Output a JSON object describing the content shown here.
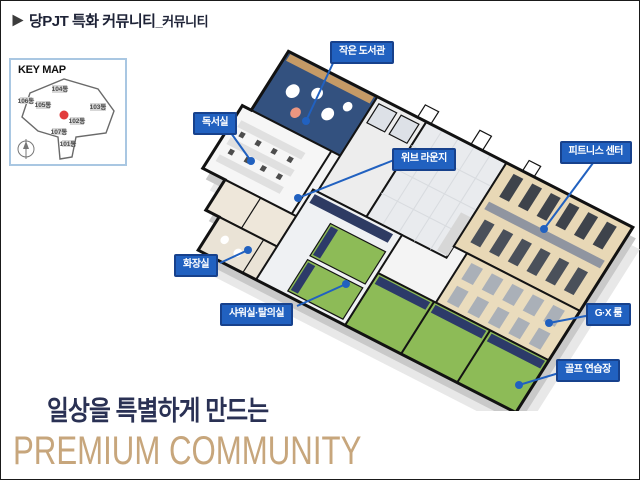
{
  "header": {
    "title_main": "당PJT 특화 커뮤니티",
    "title_suffix": "_커뮤니티"
  },
  "keymap": {
    "title": "KEY MAP",
    "buildings": [
      {
        "label": "104동"
      },
      {
        "label": "106동"
      },
      {
        "label": "105동"
      },
      {
        "label": "103동"
      },
      {
        "label": "102동"
      },
      {
        "label": "107동"
      },
      {
        "label": "101동"
      }
    ]
  },
  "floorplan": {
    "callouts": [
      {
        "label": "작은 도서관"
      },
      {
        "label": "독서실"
      },
      {
        "label": "위브 라운지"
      },
      {
        "label": "피트니스 센터"
      },
      {
        "label": "화장실"
      },
      {
        "label": "샤워실·탈의실"
      },
      {
        "label": "G·X 룸"
      },
      {
        "label": "골프 연습장"
      }
    ]
  },
  "tagline": {
    "line1": "일상을 특별하게 만드는",
    "line2": "PREMIUM COMMUNITY"
  },
  "colors": {
    "callout_blue": "#2161c0",
    "callout_border": "#17418c",
    "tagline_navy": "#2a3154",
    "tagline_gold": "#c7a67c",
    "keymap_marker_red": "#e23c3c"
  }
}
